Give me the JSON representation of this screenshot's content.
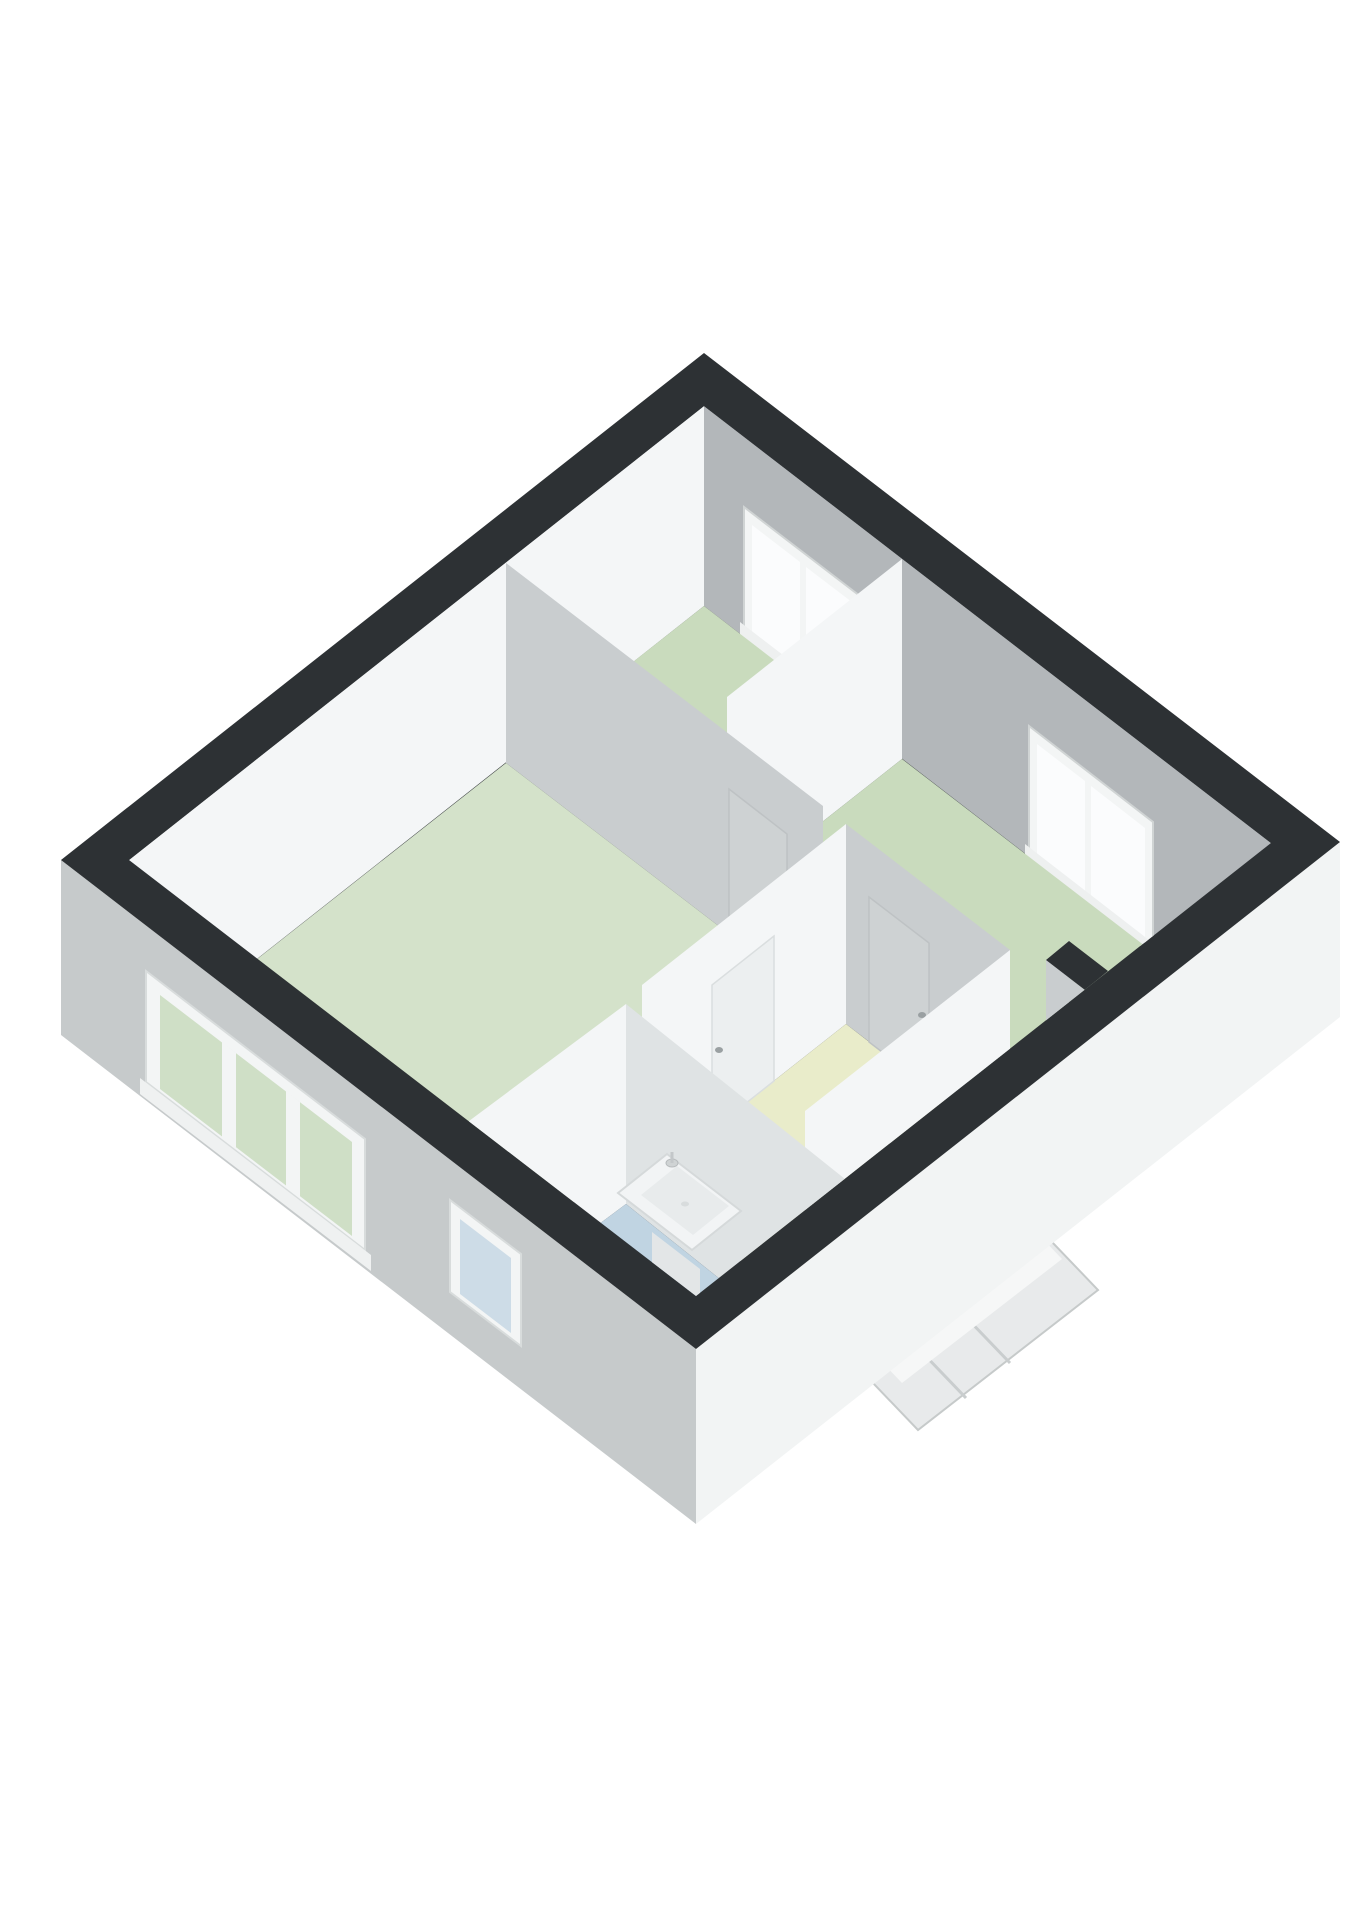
{
  "scene": {
    "type": "3d-floor-plan",
    "view": "isometric-birdseye",
    "background": "#ffffff"
  },
  "palette": {
    "wall_top_dark": "#2d3134",
    "face_white": "#f4f6f7",
    "face_white_bright": "#fafbfc",
    "face_gray": "#b3b7ba",
    "face_gray_light": "#c9cdcf",
    "face_sink_wall": "#dfe3e4",
    "outer_wall_left": "#c6cacb",
    "outer_wall_right": "#f2f4f4",
    "floor_green": "#c9dbbd",
    "floor_green_light": "#d4e2ca",
    "floor_blue": "#c0d4e2",
    "floor_yellow": "#e9ecca",
    "window_frame": "#f3f5f5",
    "window_frame_edge": "#d8dcdc",
    "window_pane_bright": "#fbfcfd",
    "window_pane_green": "#cfdfc6",
    "window_pane_blue": "#cddce7",
    "door_panel": "#ced2d3",
    "door_panel_light": "#eceff0",
    "door_handle": "#9aa0a2",
    "fixture_white": "#f2f4f5",
    "fixture_inner": "#e8ebec",
    "fixture_edge": "#d5d9da",
    "stairs_light": "#e8eaeb",
    "stairs_edge": "#c6caca"
  },
  "rooms": [
    {
      "id": "room-top-middle",
      "name": "bedroom-top",
      "floor": "green"
    },
    {
      "id": "room-right",
      "name": "bedroom-right",
      "floor": "green"
    },
    {
      "id": "room-left",
      "name": "living-room",
      "floor": "green"
    },
    {
      "id": "hall",
      "name": "landing-hall",
      "floor": "yellow"
    },
    {
      "id": "wc",
      "name": "toilet-room",
      "floor": "blue"
    },
    {
      "id": "bathroom",
      "name": "bathroom",
      "floor": "blue"
    }
  ],
  "fixtures": {
    "windows": [
      "top-wall-left",
      "top-wall-right",
      "left-wall-large-3pane",
      "left-wall-small"
    ],
    "doors": [
      "left-room-to-top-room",
      "hall-to-right-room",
      "hall-to-left-room"
    ],
    "sink": "bathroom-wall-sink",
    "toilet": "bathroom-toilet",
    "exterior": "staircase-protrusion"
  }
}
